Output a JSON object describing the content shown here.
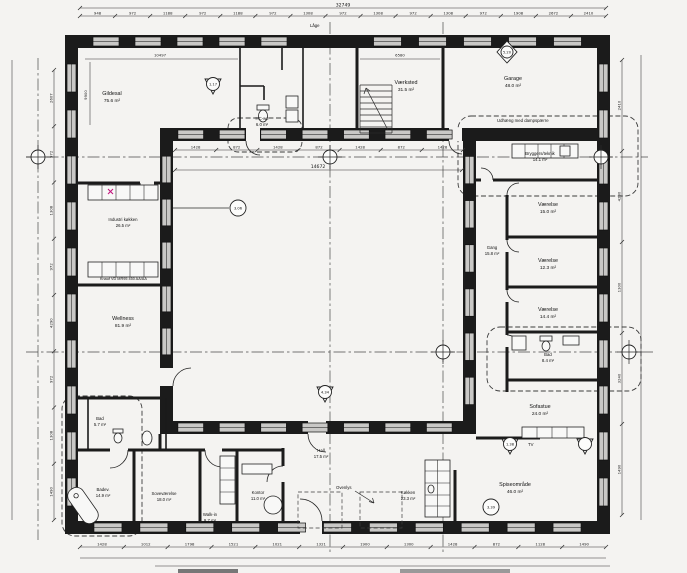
{
  "meta": {
    "drawing_type": "Architectural floor plan (stueplan)",
    "language": "Danish",
    "paper_color": "#f4f3f1",
    "line_color": "#1b1b1b",
    "accent_color": "#c2187e"
  },
  "rooms": {
    "gildesal": {
      "name": "Gildesal",
      "area": "75.6 m²"
    },
    "hcwc": {
      "name": "HC-wc",
      "area": "6.0 m²"
    },
    "vaerksted": {
      "name": "Værksted",
      "area": "31.5 m²"
    },
    "garage": {
      "name": "Garage",
      "area": "48.0 m²"
    },
    "bryggers": {
      "name": "Bryggers/teknik",
      "area": "14.1 m²"
    },
    "vaerelse1": {
      "name": "Værelse",
      "area": "15.0 m²"
    },
    "gang": {
      "name": "Gang",
      "area": "15.8 m²"
    },
    "vaerelse2": {
      "name": "Værelse",
      "area": "12.3 m²"
    },
    "vaerelse3": {
      "name": "Værelse",
      "area": "14.4 m²"
    },
    "bad1": {
      "name": "Bad",
      "area": "8.4 m²"
    },
    "sofastue": {
      "name": "Sofastue",
      "area": "24.0 m²"
    },
    "spiseomraade": {
      "name": "Spiseområde",
      "area": "46.0 m²"
    },
    "koekken": {
      "name": "Køkken",
      "area": "23.3 m²"
    },
    "hall": {
      "name": "Hall",
      "area": "17.5 m²"
    },
    "kontor": {
      "name": "Kontor",
      "area": "11.0 m²"
    },
    "walkin": {
      "name": "Walk-in",
      "area": "9.7 m²"
    },
    "sovevaerelse": {
      "name": "Soveværelse",
      "area": "18.0 m²"
    },
    "bad2": {
      "name": "Bad",
      "area": "5.7 m²"
    },
    "badev": {
      "name": "Badev.",
      "area": "14.9 m²"
    },
    "wellness": {
      "name": "Wellness",
      "area": "81.9 m²"
    },
    "industrikoekken": {
      "name": "Industri køkken",
      "area": "26.5 m²"
    }
  },
  "notes": {
    "udhaeng": "Udhæng med dampspærre",
    "knauf": "Knauf VD MR95 450 AA/AA",
    "ovenlys": "Ovenlys",
    "laage": "Låge",
    "tv": "TV"
  },
  "markers": {
    "m117": "1.17",
    "m520": "5.20",
    "m306": "3.06",
    "m434": "4.34",
    "m138": "1.38",
    "m339": "3.39"
  },
  "dimensions": {
    "top_total": "32749",
    "top_segments": "948 972 1188 972 1188 972 1308 972 1308 972 1308 972 1908 2672 2410",
    "bottom_segments": "1428 1012 1798 1521 1021 1321 1900 1300 1428 872 1128 1490",
    "left_segments": "2607 972 1308 972 4290 972 1308 1490",
    "right_segments": "2410 4230 1300 3240 1490",
    "inner_top_segments": "1428 872 1428 872 1428 872 1428",
    "courtyard_width": "14672",
    "gildesal_width": "10497",
    "top_mid_width": "6580",
    "gildesal_height": "9900"
  }
}
